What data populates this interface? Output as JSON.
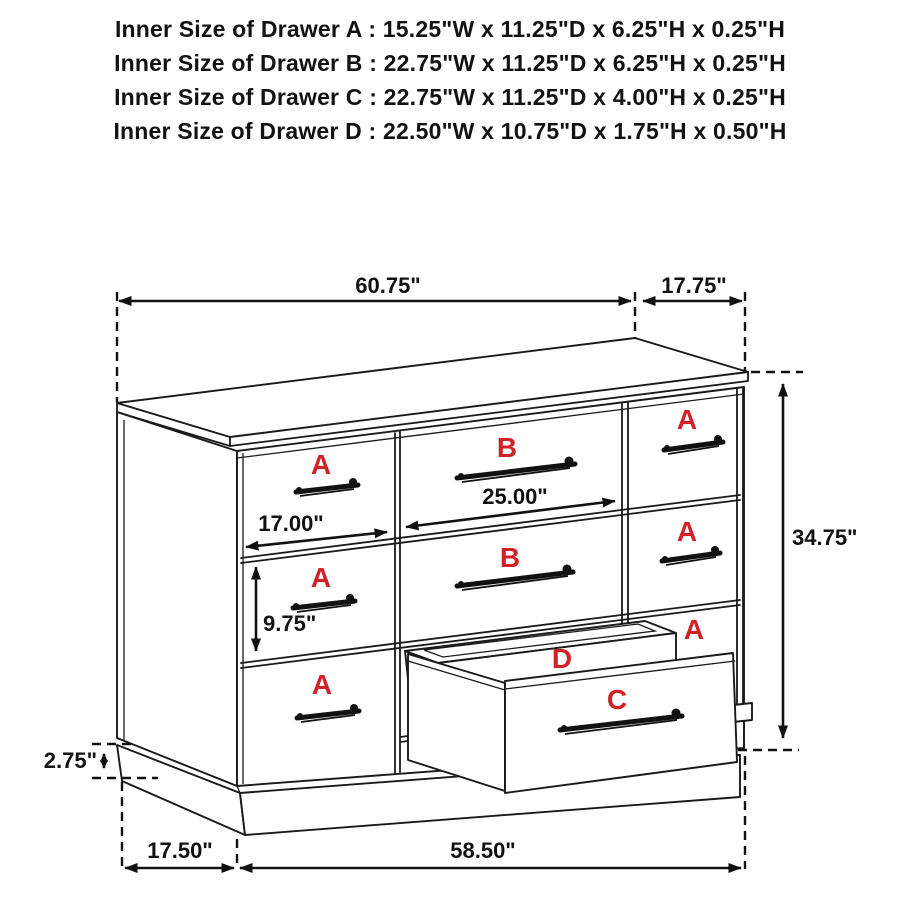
{
  "colors": {
    "line_black": "#1a1a1a",
    "label_red": "#d22027",
    "background": "#ffffff"
  },
  "header": {
    "lines": [
      "Inner Size of Drawer A : 15.25\"W x 11.25\"D x 6.25\"H x 0.25\"H",
      "Inner Size of Drawer B : 22.75\"W x 11.25\"D x 6.25\"H x 0.25\"H",
      "Inner Size of Drawer C : 22.75\"W x 11.25\"D x 4.00\"H x 0.25\"H",
      "Inner Size of Drawer D : 22.50\"W x 10.75\"D x 1.75\"H x 0.50\"H"
    ]
  },
  "diagram": {
    "dimensions": {
      "overall_width": "60.75\"",
      "overall_depth": "17.75\"",
      "overall_height": "34.75\"",
      "drawer_a_front_width": "17.00\"",
      "drawer_b_front_width": "25.00\"",
      "drawer_front_height": "9.75\"",
      "base_height": "2.75\"",
      "base_depth": "17.50\"",
      "base_width": "58.50\""
    },
    "drawer_labels": {
      "left_top": "A",
      "left_middle": "A",
      "left_bottom": "A",
      "center_top": "B",
      "center_middle": "B",
      "right_top": "A",
      "right_middle": "A",
      "right_bottom": "A",
      "tray": "D",
      "pulled_drawer": "C"
    }
  }
}
